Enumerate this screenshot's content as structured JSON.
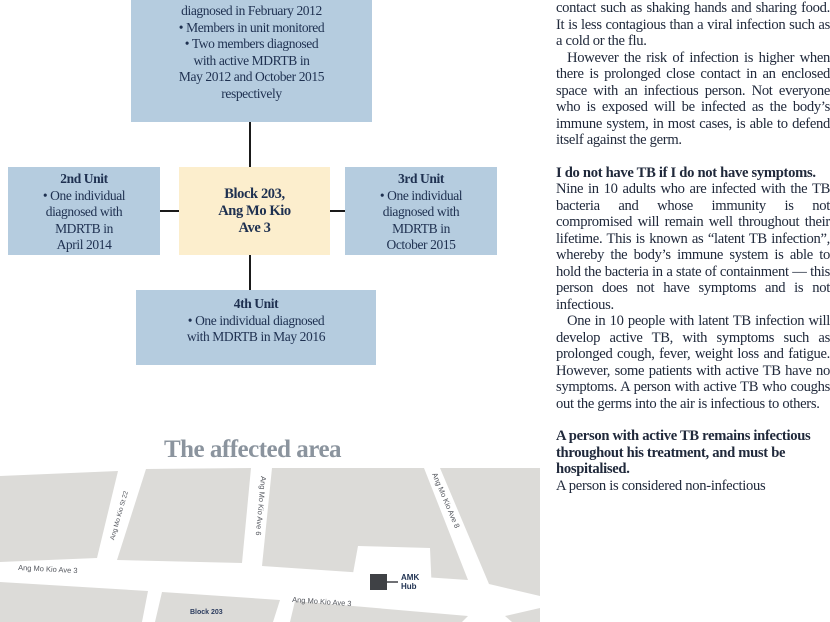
{
  "colors": {
    "boxBlue": "#b5ccdf",
    "boxCream": "#fceecd",
    "navy": "#1e3050",
    "ink": "#20293b",
    "line": "#1a1a1a",
    "mapGray": "#dcdbd8",
    "mapLabel": "#54575e",
    "mapNavy": "#2c3c5e",
    "headGray": "#8b949e"
  },
  "diagram": {
    "unit1": {
      "lines": [
        "diagnosed in February 2012",
        "• Members in unit monitored",
        "• Two members diagnosed",
        "with active MDRTB in",
        "May 2012 and October 2015",
        "respectively"
      ]
    },
    "unit2": {
      "title": "2nd Unit",
      "lines": [
        "• One individual",
        "diagnosed with",
        "MDRTB in",
        "April 2014"
      ]
    },
    "unit3": {
      "title": "3rd Unit",
      "lines": [
        "• One individual",
        "diagnosed with",
        "MDRTB in",
        "October 2015"
      ]
    },
    "unit4": {
      "title": "4th Unit",
      "lines": [
        "• One individual diagnosed",
        "with MDRTB in May 2016"
      ]
    },
    "center": {
      "lines": [
        "Block 203,",
        "Ang Mo Kio",
        "Ave 3"
      ]
    }
  },
  "map": {
    "title": "The affected area",
    "roads": {
      "small_street": "Ang Mo Kio St 22",
      "ave6": "Ang Mo Kio Ave 6",
      "ave8": "Ang Mo Kio Ave 8",
      "ave3_left": "Ang Mo Kio Ave 3",
      "ave3_right": "Ang Mo Kio Ave 3"
    },
    "block_label": "Block 203",
    "marker": {
      "label_line1": "AMK",
      "label_line2": "Hub"
    }
  },
  "article": {
    "paragraphs": [
      {
        "style": "body",
        "text": "contact such as shaking hands and sharing food. It is less contagious than a viral infection such as a cold or the flu."
      },
      {
        "style": "body-indent",
        "text": "However the risk of infection is higher when there is prolonged close contact in an enclosed space with an infectious person. Not everyone who is exposed will be infected as the body’s immune system, in most cases, is able to defend itself against the germ."
      },
      {
        "style": "heading",
        "text": "I do not have TB if I do not have symptoms."
      },
      {
        "style": "body",
        "text": "Nine in 10 adults who are infected with the TB bacteria and whose immunity is not compromised will remain well throughout their lifetime. This is known as “latent TB infection”, whereby the body’s immune system is able to hold the bacteria in a state of containment — this person does not have symptoms and is not infectious."
      },
      {
        "style": "body-indent",
        "text": "One in 10 people with latent TB infection will develop active TB, with symptoms such as prolonged cough, fever, weight loss and fatigue. However, some patients with active TB have no symptoms. A person with active TB who coughs out the germs into the air is infectious to others."
      },
      {
        "style": "heading",
        "text": "A person with active TB remains infectious throughout his treatment, and must be hospitalised."
      },
      {
        "style": "body",
        "text": "A person is considered non-infectious"
      }
    ]
  }
}
